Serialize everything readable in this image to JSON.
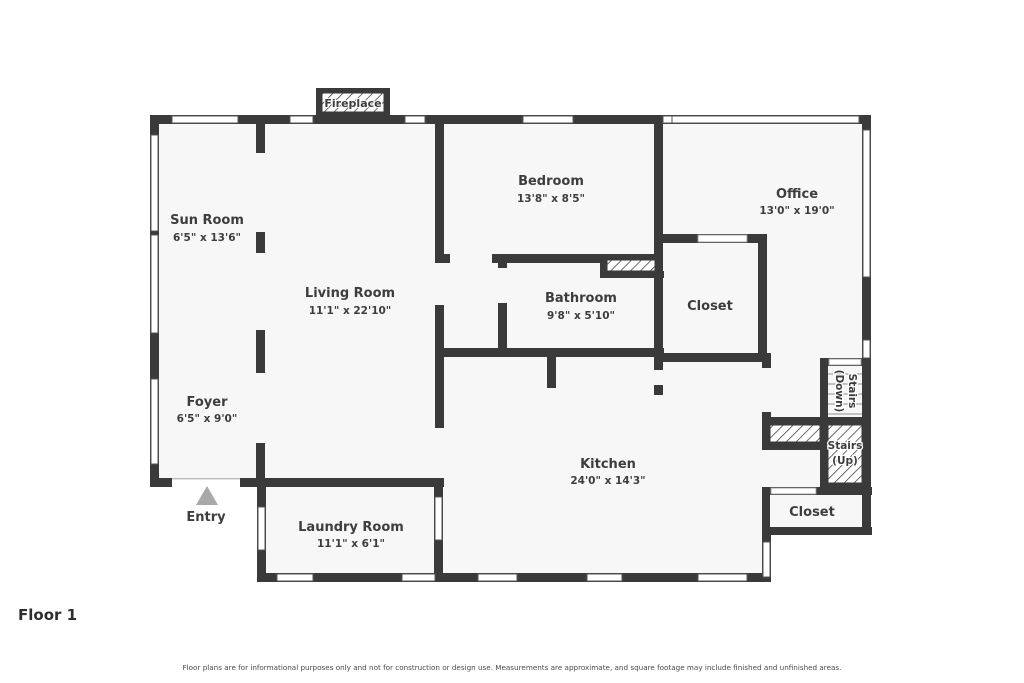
{
  "rooms": {
    "sun_room": {
      "name": "Sun Room",
      "dims": "6'5\" x 13'6\""
    },
    "living_room": {
      "name": "Living Room",
      "dims": "11'1\" x 22'10\""
    },
    "foyer": {
      "name": "Foyer",
      "dims": "6'5\" x 9'0\""
    },
    "bedroom": {
      "name": "Bedroom",
      "dims": "13'8\" x 8'5\""
    },
    "office": {
      "name": "Office",
      "dims": "13'0\" x 19'0\""
    },
    "bathroom": {
      "name": "Bathroom",
      "dims": "9'8\" x 5'10\""
    },
    "kitchen": {
      "name": "Kitchen",
      "dims": "24'0\" x 14'3\""
    },
    "laundry": {
      "name": "Laundry Room",
      "dims": "11'1\" x 6'1\""
    },
    "closet_hall": {
      "name": "Closet"
    },
    "closet_rear": {
      "name": "Closet"
    }
  },
  "stairs": {
    "down": {
      "line1": "Stairs",
      "line2": "(Down)"
    },
    "up": {
      "line1": "Stairs",
      "line2": "(Up)"
    }
  },
  "fireplace": {
    "label": "Fireplace"
  },
  "entry": {
    "label": "Entry"
  },
  "footer": {
    "floor_label": "Floor 1",
    "disclaimer": "Floor plans are for informational purposes only and not for construction or design use. Measurements are approximate, and square footage may include finished and unfinished areas."
  },
  "colors": {
    "wall": "#3a3a3a",
    "floor": "#f7f7f7",
    "text": "#3d3d3d",
    "arrow": "#a9a9a9"
  }
}
